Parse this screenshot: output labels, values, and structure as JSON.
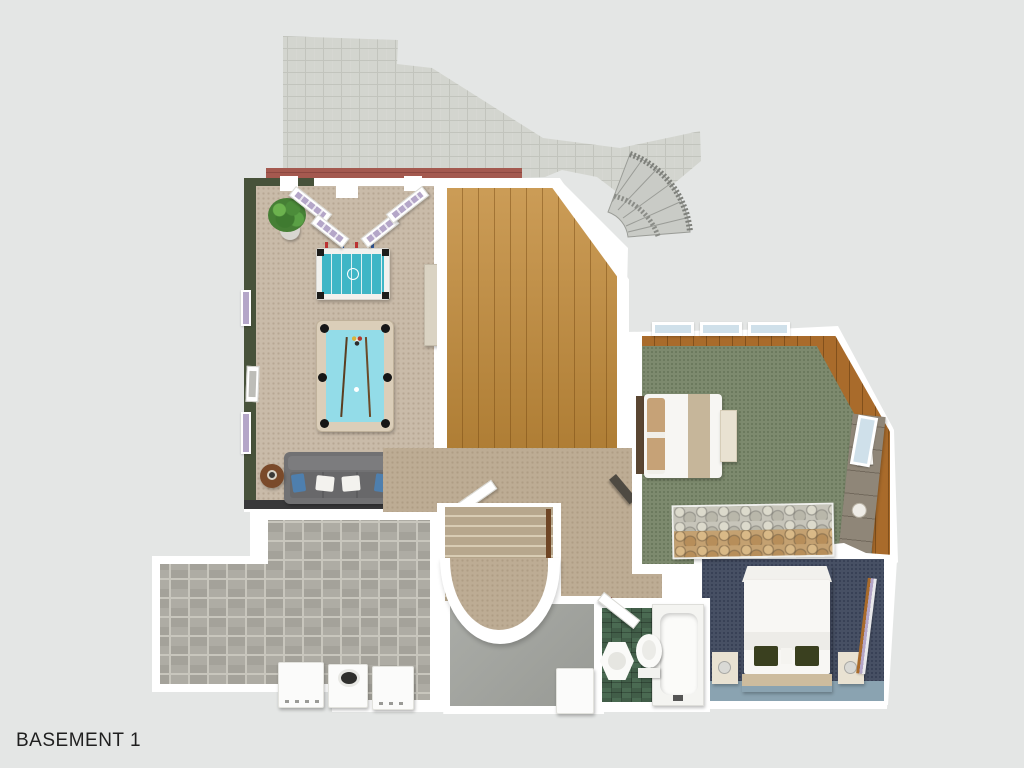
{
  "label": {
    "text": "BASEMENT 1"
  },
  "palette": {
    "bg": "#e4e6e5",
    "wall": "#ffffff",
    "paver": "#d3d5cf",
    "paverLine": "#c2c4bd",
    "brick": "#a4594f",
    "brickLine": "#8c4841",
    "greenWall": "#47523a",
    "carpetTan": "#c9bba9",
    "carpetBeige": "#bdac94",
    "carpetGreen": "#7d8a6e",
    "slate": "#475064",
    "slateLight": "#8aa3b1",
    "wood": "#c38c3b",
    "woodTrim": "#a96b2b",
    "tileGray": "#aeaca4",
    "grout": "#c8c6bd",
    "tileGreen": "#4a6a52",
    "concrete": "#a2a49f",
    "stoneTan": "#c4a171",
    "stoneGray": "#c7c5ba",
    "poolFelt": "#93dce8",
    "poolRail": "#dbceb9",
    "foosTeal": "#3fb6c6",
    "sofa": "#717173",
    "pillowBlue": "#4e7fae",
    "lavender": "#b4a6c8",
    "skyGlass": "#cfe0ea",
    "stepTread": "#b7a78d",
    "stepLight": "#d8ccb4",
    "railBrown": "#6f4524",
    "cream": "#e9e2d2",
    "deskWood": "#8f8678",
    "headboard": "#5a4632",
    "tanBand": "#c6b69a",
    "olivePillow": "#3a401f",
    "platformTan": "#cdbc9e",
    "darkDoor": "#4e4a42",
    "tvBlack": "#1c1c1c"
  },
  "rooms": [
    {
      "name": "patio"
    },
    {
      "name": "game-room"
    },
    {
      "name": "wood-floor-room"
    },
    {
      "name": "hallway-stairs"
    },
    {
      "name": "bedroom-green"
    },
    {
      "name": "bedroom-blue"
    },
    {
      "name": "bathroom"
    },
    {
      "name": "laundry-room"
    },
    {
      "name": "storage-room"
    }
  ],
  "furniture": [
    "potted-plant",
    "foosball-table",
    "pool-table",
    "sofa",
    "side-table",
    "tv",
    "media-console",
    "wall-picture",
    "french-doors",
    "outdoor-curved-stair",
    "staircase",
    "curved-landing",
    "bed",
    "bed-bench",
    "desk",
    "stone-accent-wall",
    "double-bed",
    "nightstand",
    "bathtub",
    "toilet",
    "pedestal-sink",
    "washer",
    "dryer",
    "freezer"
  ]
}
